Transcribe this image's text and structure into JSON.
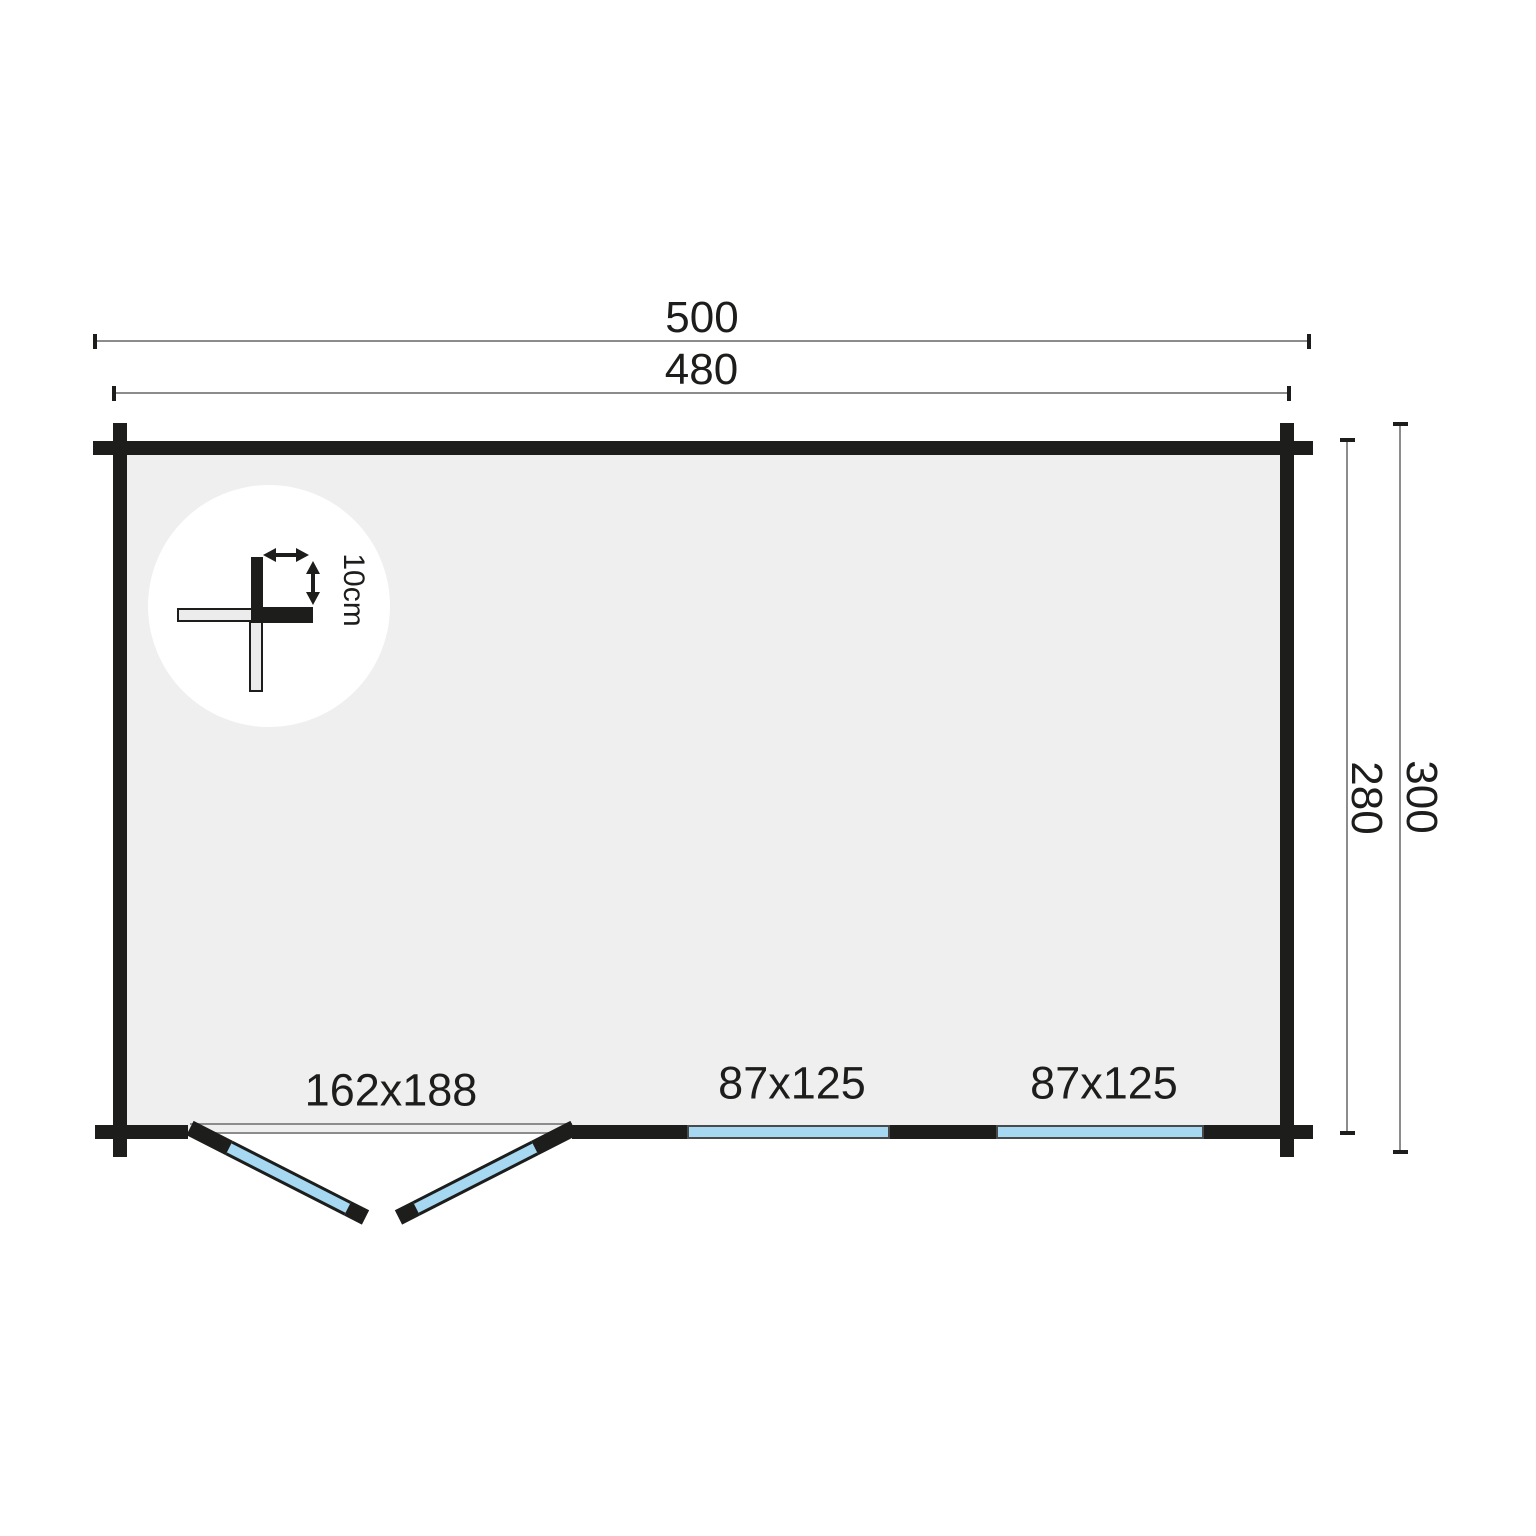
{
  "plan": {
    "dimensions": {
      "outer_width": "500",
      "inner_width": "480",
      "inner_depth": "280",
      "outer_depth": "300"
    },
    "openings": {
      "door_label": "162x188",
      "window1_label": "87x125",
      "window2_label": "87x125"
    },
    "detail": {
      "wall_thickness_label": "10cm"
    }
  },
  "colors": {
    "wall": "#1d1d1b",
    "glass": "#a6d8f2",
    "floor": "#efeff0",
    "dim-line": "#8c8c8c",
    "background": "#ffffff"
  }
}
